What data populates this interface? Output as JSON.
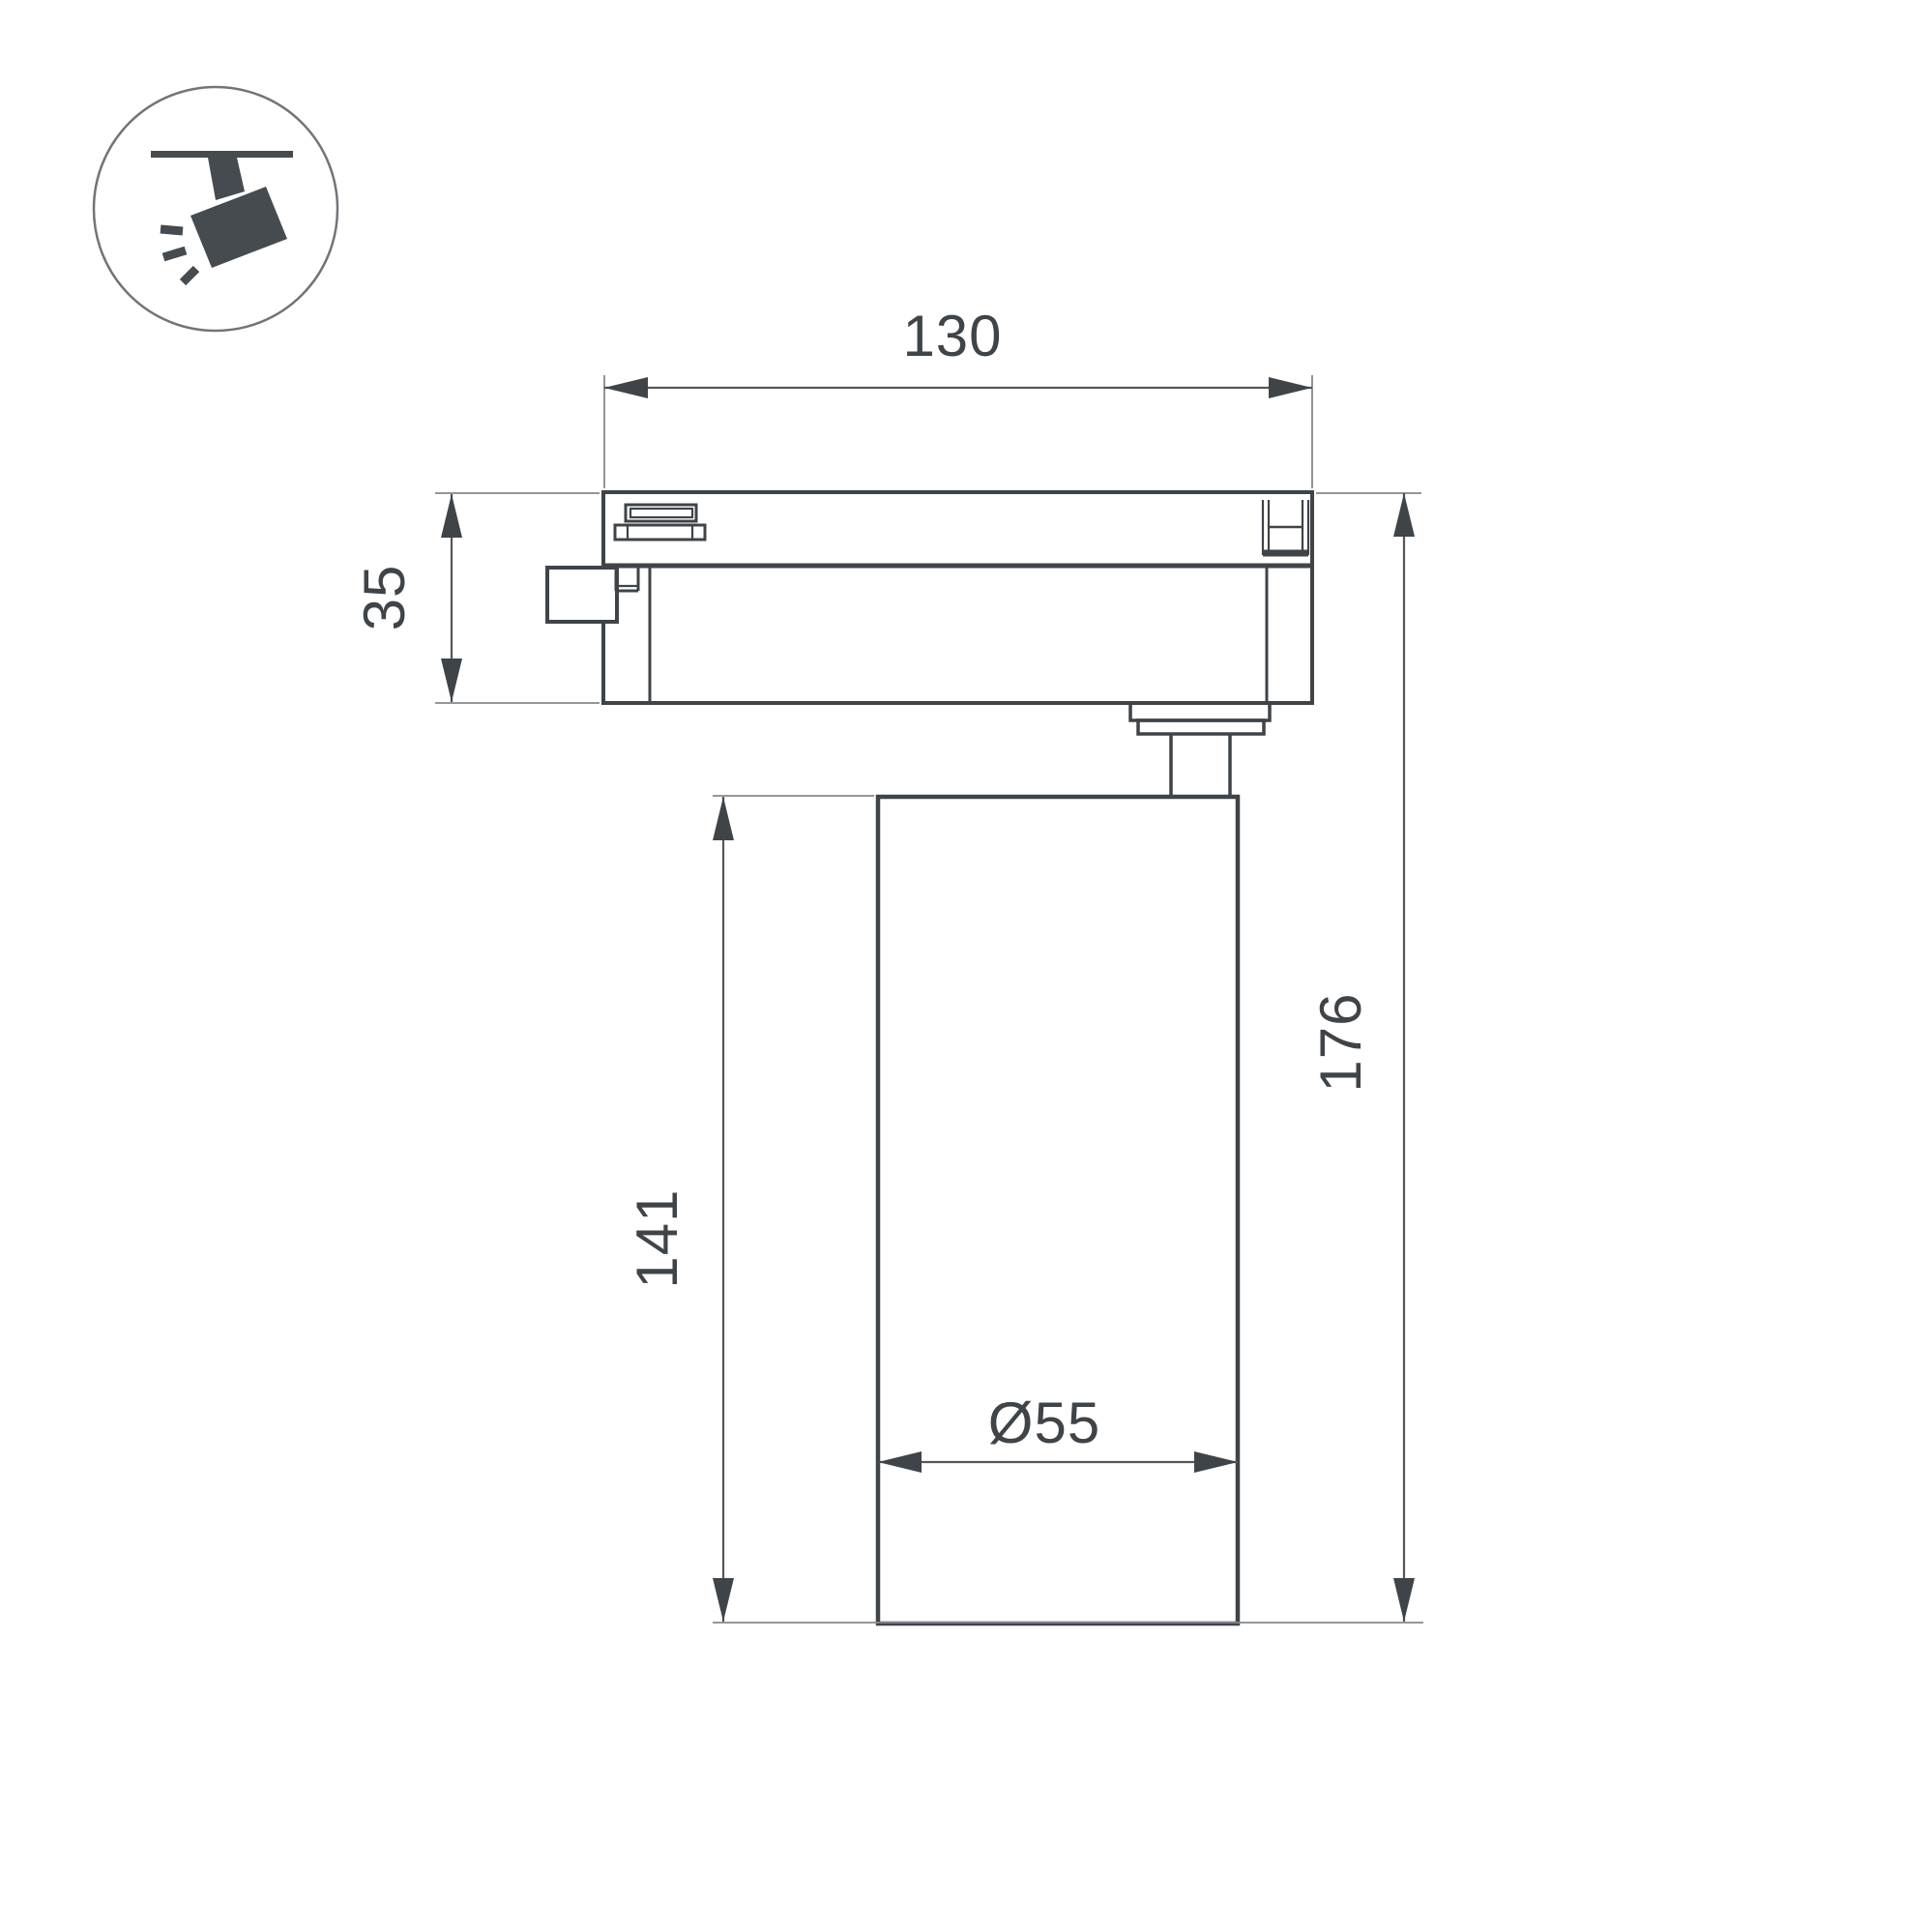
{
  "title": "Track spotlight dimension drawing",
  "colors": {
    "background": "#ffffff",
    "line": "#3f4449",
    "dimension_line": "#53575c",
    "extension_line": "#85888c",
    "text": "#3f4449"
  },
  "icon": {
    "name": "track-spotlight-icon",
    "description": "spotlight hanging from ceiling track, tilted, emitting light rays"
  },
  "dimensions": {
    "track_length": "130",
    "track_height": "35",
    "body_height": "141",
    "total_height": "176",
    "diameter": "Ø55"
  }
}
